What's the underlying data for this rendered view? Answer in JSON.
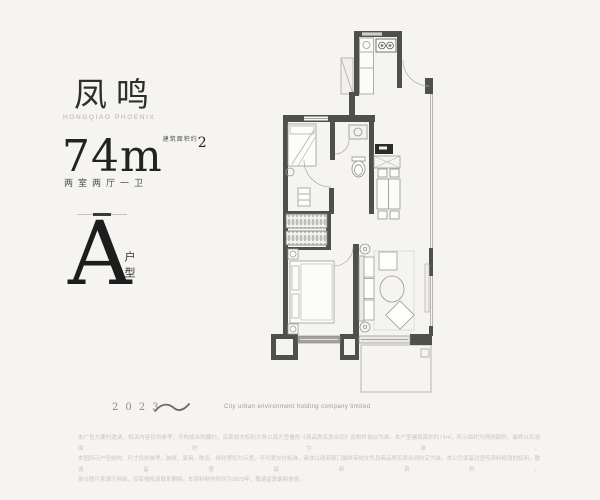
{
  "brand": {
    "title": "凤鸣",
    "subtitle": "HONGQIAO PHOENIX"
  },
  "area": {
    "value": "74",
    "unit": "m",
    "sup": "2",
    "note": "建筑面积约",
    "rooms": "两室两厅一卫"
  },
  "unit_type": {
    "letter": "A",
    "label": "户型"
  },
  "footer": {
    "year": "2023",
    "company": "City urban environment holding company limited",
    "disclaimer_lines": [
      "本广告为要约邀请，相关内容仅供参考，不构成合同要约，买卖双方权利义务以双方签署的《商品房买卖合同》及附件协议为准。本户型建筑面积约74㎡，所示面积为预测面积，最终以实测面积为准。",
      "本图所示户型结构、尺寸仅供参考，装修、家具、陈设、绿化等仅为示意，不代表交付标准，具体以政府部门最终审批文件及商品房买卖合同约定为准，本公司保留对宣传资料修改的权利，敬请留意最新资料。",
      "部分图片来源于网络，如有侵权请联系删除，本资料制作时间为2023年，敬请留意最新信息。"
    ]
  },
  "colors": {
    "background": "#f5f4f1",
    "wall": "#4f4f4d",
    "ink": "#2e2e2e",
    "muted": "#b3b1ae"
  }
}
